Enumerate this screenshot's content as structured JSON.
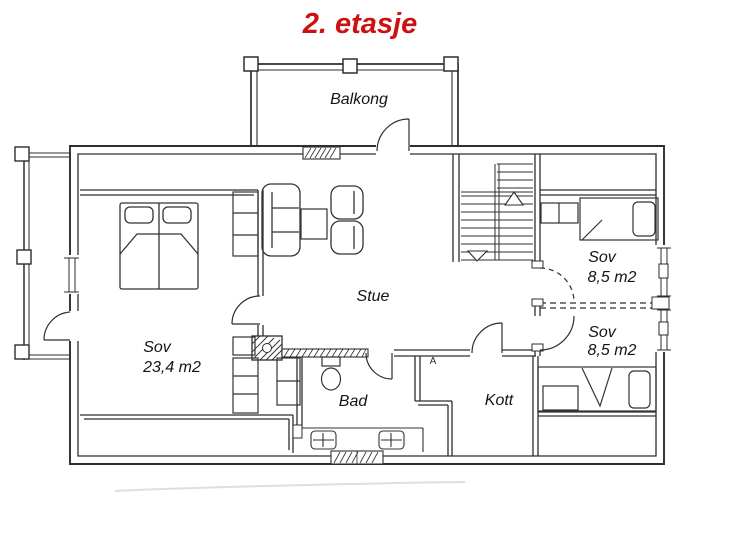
{
  "colors": {
    "ink": "#2e2e2e",
    "title_red": "#cc1111",
    "paper": "#ffffff"
  },
  "title": {
    "text": "2. etasje"
  },
  "rooms": {
    "balcony": {
      "label": "Balkong"
    },
    "living_room": {
      "label": "Stue"
    },
    "master_bedroom": {
      "label": "Sov",
      "area": "23,4 m2"
    },
    "bedroom_ne": {
      "label": "Sov",
      "area": "8,5 m2"
    },
    "bedroom_se": {
      "label": "Sov",
      "area": "8,5 m2"
    },
    "bathroom": {
      "label": "Bad"
    },
    "closet": {
      "label": "Kott"
    }
  },
  "markers": {
    "vent_label": "A"
  }
}
